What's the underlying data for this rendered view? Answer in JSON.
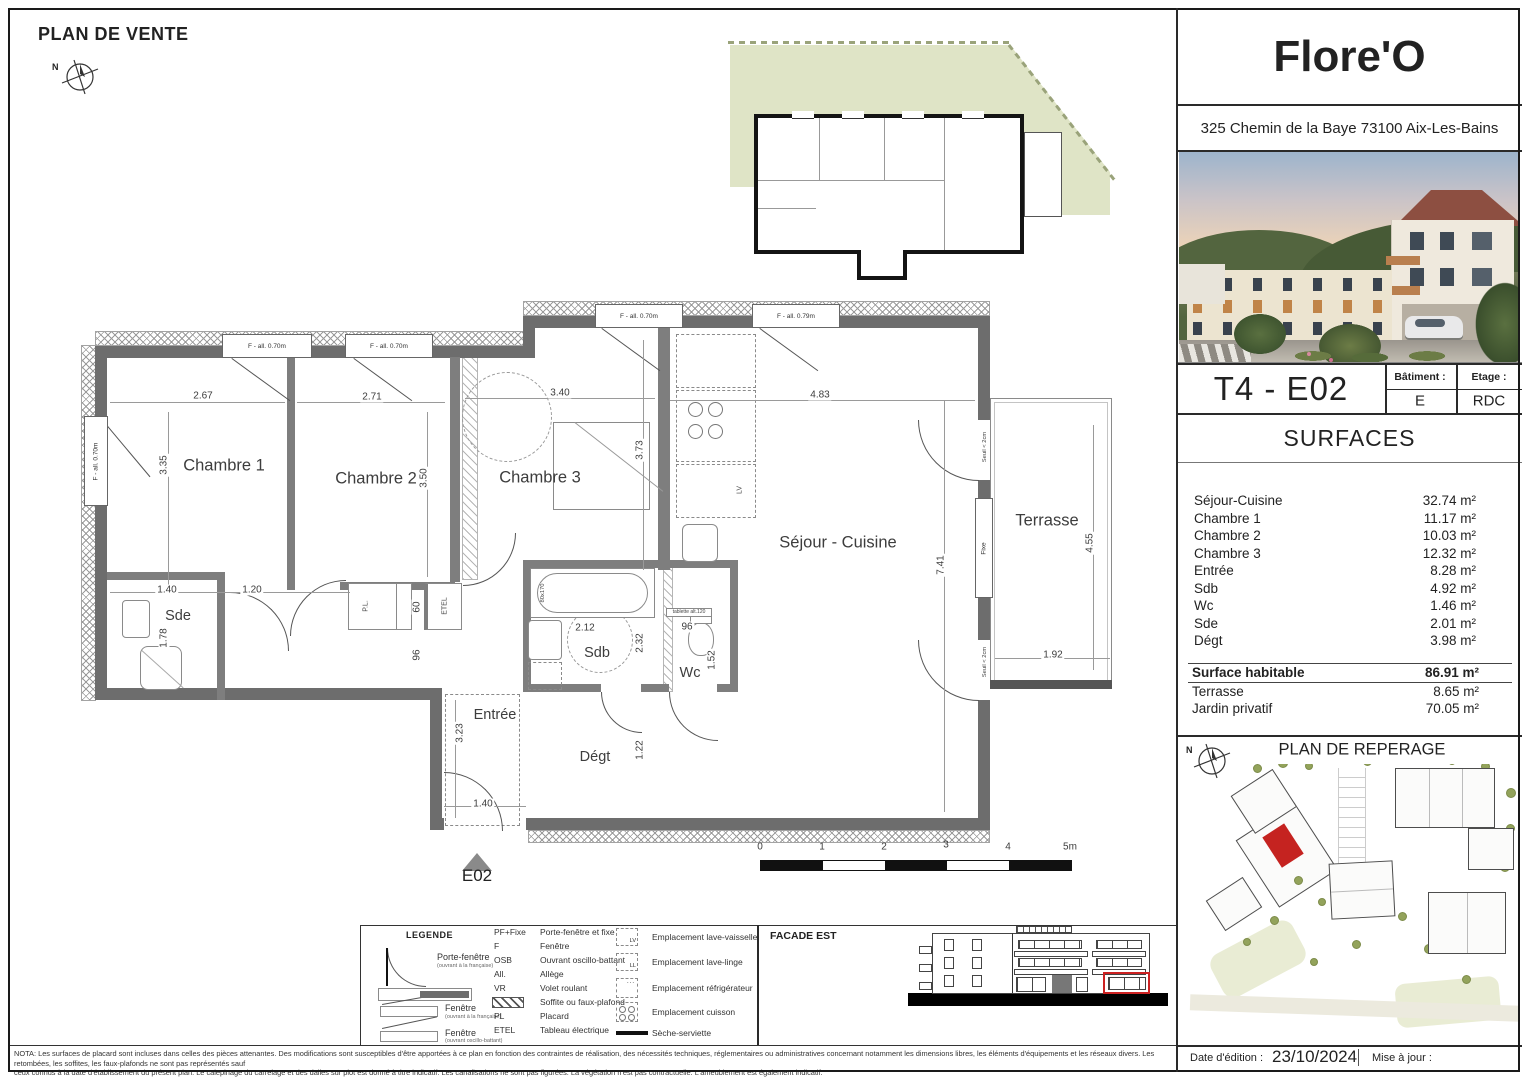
{
  "sheet": {
    "title": "PLAN DE VENTE",
    "marker": "E02",
    "north": "N",
    "scale": {
      "t0": "0",
      "t1": "1",
      "t2": "2",
      "t3": "3",
      "t4": "4",
      "t5": "5m"
    }
  },
  "project": {
    "name": "Flore'O",
    "address": "325 Chemin de la Baye 73100 Aix-Les-Bains",
    "unit": "T4 - E02",
    "batiment_label": "Bâtiment :",
    "batiment_value": "E",
    "etage_label": "Etage :",
    "etage_value": "RDC"
  },
  "surfaces": {
    "heading": "SURFACES",
    "rows": [
      {
        "label": "Séjour-Cuisine",
        "value": "32.74 m²"
      },
      {
        "label": "Chambre 1",
        "value": "11.17 m²"
      },
      {
        "label": "Chambre 2",
        "value": "10.03 m²"
      },
      {
        "label": "Chambre 3",
        "value": "12.32 m²"
      },
      {
        "label": "Entrée",
        "value": "8.28 m²"
      },
      {
        "label": "Sdb",
        "value": "4.92 m²"
      },
      {
        "label": "Wc",
        "value": "1.46 m²"
      },
      {
        "label": "Sde",
        "value": "2.01 m²"
      },
      {
        "label": "Dégt",
        "value": "3.98 m²"
      }
    ],
    "totals": [
      {
        "label": "Surface habitable",
        "value": "86.91 m²"
      },
      {
        "label": "Terrasse",
        "value": "8.65 m²"
      },
      {
        "label": "Jardin privatif",
        "value": "70.05 m²"
      }
    ]
  },
  "floorplan": {
    "rooms": {
      "chambre1": "Chambre 1",
      "chambre2": "Chambre 2",
      "chambre3": "Chambre 3",
      "sejour": "Séjour - Cuisine",
      "terrasse": "Terrasse",
      "sde": "Sde",
      "sdb": "Sdb",
      "wc": "Wc",
      "entree": "Entrée",
      "degt": "Dégt"
    },
    "dims": {
      "d1": "2.67",
      "d2": "2.71",
      "d3": "3.40",
      "d4": "4.83",
      "d5": "3.35",
      "d6": "3.50",
      "d7": "3.73",
      "d8": "7.41",
      "d9": "4.55",
      "d10": "1.92",
      "d11": "1.40",
      "d12": "1.20",
      "d13": "1.78",
      "d14": "2.12",
      "d15": "2.32",
      "d16": "96",
      "d17": "1.52",
      "d18": "60",
      "d19": "96",
      "d20": "3.23",
      "d21": "1.22",
      "d22": "1.40"
    },
    "windows": {
      "w1": "F - all. 0.70m",
      "w2": "F - all. 0.70m",
      "w3": "F - all. 0.70m",
      "w4": "F - all. 0.79m",
      "w5": "F - all. 0.70m"
    },
    "annotations": {
      "pl": "P.L.",
      "etel": "ETEL",
      "lv": "LV",
      "tub": "80x170",
      "tablette": "tablette alt.120",
      "fixe": "Fixe",
      "seuil": "Seuil < 2cm"
    }
  },
  "legend": {
    "heading": "LEGENDE",
    "drawings": [
      {
        "label": "Porte-fenêtre",
        "sub": "(ouvrant à la française)"
      },
      {
        "label": "Fenêtre",
        "sub": "(ouvrant à la française)"
      },
      {
        "label": "Fenêtre",
        "sub": "(ouvrant oscillo-battant)"
      }
    ],
    "abbreviations": [
      {
        "abbr": "PF+Fixe",
        "label": "Porte-fenêtre et fixe"
      },
      {
        "abbr": "F",
        "label": "Fenêtre"
      },
      {
        "abbr": "OSB",
        "label": "Ouvrant oscillo-battant"
      },
      {
        "abbr": "All.",
        "label": "Allège"
      },
      {
        "abbr": "VR",
        "label": "Volet roulant"
      },
      {
        "abbr": "",
        "label": "Soffite ou  faux-plafond"
      },
      {
        "abbr": "PL",
        "label": "Placard"
      },
      {
        "abbr": "ETEL",
        "label": "Tableau électrique"
      }
    ],
    "placements": [
      {
        "symbol": "LV",
        "label": "Emplacement lave-vaisselle"
      },
      {
        "symbol": "LL",
        "label": "Emplacement lave-linge"
      },
      {
        "symbol": "",
        "label": "Emplacement réfrigérateur"
      },
      {
        "symbol": "",
        "label": "Emplacement cuisson"
      },
      {
        "symbol": "",
        "label": "Sèche-serviette"
      }
    ]
  },
  "facade": {
    "heading": "FACADE EST"
  },
  "reperage": {
    "heading": "PLAN DE REPERAGE"
  },
  "footer": {
    "nota_line1": "NOTA: Les surfaces de placard sont incluses dans celles des pièces attenantes. Des modifications sont susceptibles d'être apportées à ce plan en fonction des contraintes de réalisation, des nécessités techniques, réglementaires ou administratives concernant notamment les dimensions libres, les éléments d'équipements et les réseaux divers. Les retombées, les soffites, les faux-plafonds ne sont pas représentés sauf",
    "nota_line2": "ceux connus à la date d'établissement du présent plan. Le calepinage du carrelage et des dalles sur plot est donné à titre indicatif. Les canalisations ne sont pas figurées. La végétation n'est pas contractuelle. L'ameublement est également indicatif.",
    "date_label": "Date d'édition :",
    "date_value": "23/10/2024",
    "maj_label": "Mise à jour :"
  },
  "colors": {
    "wall": "#6d6d6d",
    "jardin_green": "#dfe4c6",
    "unit_red": "#c52320"
  }
}
